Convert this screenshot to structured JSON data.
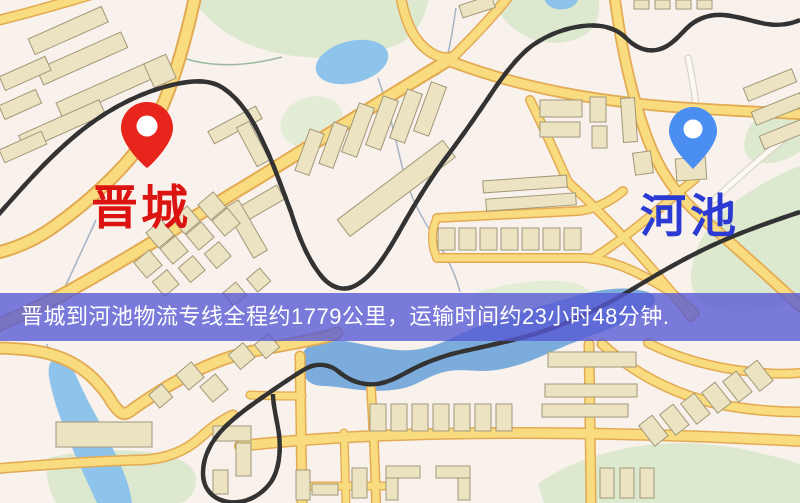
{
  "map": {
    "origin": {
      "name": "晋城"
    },
    "destination": {
      "name": "河池"
    },
    "banner": {
      "text": "晋城到河池物流专线全程约1779公里，运输时间约23小时48分钟."
    },
    "route": {
      "from": "晋城",
      "to": "河池",
      "distance_km": 1779,
      "duration": "23小时48分钟"
    },
    "icons": [
      "origin-pin-icon",
      "destination-pin-icon"
    ]
  },
  "colors": {
    "map_bg": "#f8f1ec",
    "green": "#dde9ce",
    "water": "#7bacdc",
    "water_light": "#8ec4ec",
    "road_fill": "#f9dc80",
    "road_casing": "#e3aa52",
    "building": "#ece3c3",
    "building_stroke": "#a19878",
    "rail": "#333333",
    "pin_origin": "#e8251c",
    "pin_destination": "#4b8ef2",
    "label_origin": "#dc1411",
    "label_destination": "#2a3ad2",
    "banner_bg": "rgba(86,89,214,0.78)",
    "banner_text": "#ffffff"
  }
}
